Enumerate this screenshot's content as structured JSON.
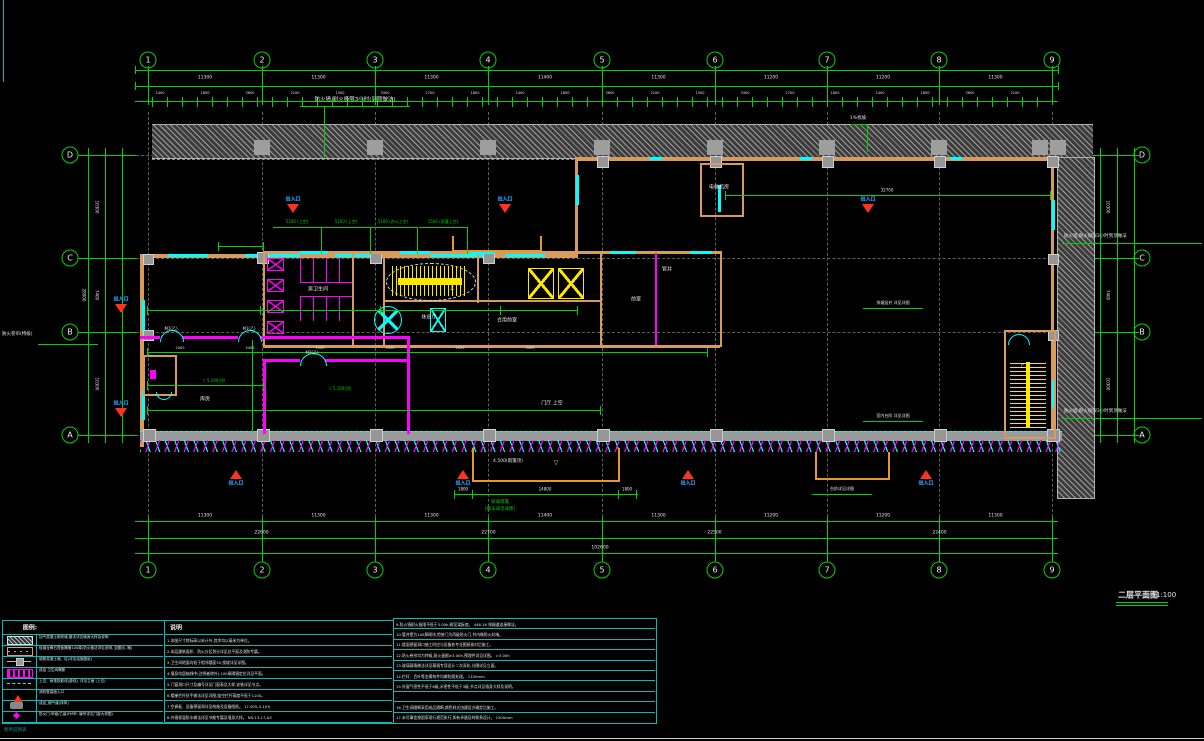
{
  "title": {
    "text": "二层平面图",
    "scale": "1:100"
  },
  "grid": {
    "cols": [
      "1",
      "2",
      "3",
      "4",
      "5",
      "6",
      "7",
      "8",
      "9"
    ],
    "rows": [
      "D",
      "C",
      "B",
      "A"
    ]
  },
  "dims": {
    "top_bays": [
      "11300",
      "11300",
      "11300",
      "11400",
      "11300",
      "11200",
      "11200",
      "11300"
    ],
    "top_fine": [
      "2400",
      "1800",
      "3600",
      "2100",
      "1500",
      "3300",
      "2700",
      "1800"
    ],
    "bottom_bays": [
      "11300",
      "11300",
      "11300",
      "11400",
      "11300",
      "11200",
      "11200",
      "11300"
    ],
    "bottom_spans": [
      "22600",
      "22700",
      "22500",
      "22400"
    ],
    "bottom_overall": "102600",
    "left": [
      "10300",
      "7400",
      "10300"
    ],
    "left_overall": "28000",
    "right": [
      "10300",
      "7400",
      "10300"
    ],
    "canopy": [
      "1800",
      "14800",
      "1800"
    ],
    "upper_span": "32700",
    "inner": [
      "2000",
      "5400",
      "1500",
      "3300",
      "2000",
      "5400"
    ]
  },
  "annotations": {
    "firewall_top": "防火墙,耐火极限3小时(到顶做法)",
    "firewall_right_upper": "防火墙,耐火极限3小时到顶做法",
    "firewall_right_lower": "防火墙,耐火极限3小时到顶做法",
    "slope": "1%找坡",
    "shutter": "防火卷帘(特级)",
    "upper_labels": [
      "5100 (上空)",
      "5100 (上空)",
      "5100 (办公上空)",
      "1500 (雨篷上空)"
    ],
    "canopy_level": "4.500(雨篷顶)",
    "canopy_note_1": "玻璃雨篷",
    "canopy_note_2": "(做法详见详图)",
    "leaders": [
      {
        "text": "排烟竖井 详见详图",
        "x": 893,
        "y": 303
      },
      {
        "text": "室内台阶 详见详图",
        "x": 893,
        "y": 416
      },
      {
        "text": "台阶详见详图",
        "x": 842,
        "y": 489
      }
    ],
    "levels": [
      {
        "text": "5.100(顶)",
        "x": 214,
        "y": 381
      },
      {
        "text": "5.100(顶)",
        "x": 340,
        "y": 389
      }
    ],
    "doors": [
      {
        "text": "M1(乙)",
        "x": 171,
        "y": 329
      },
      {
        "text": "M1(乙)",
        "x": 249,
        "y": 329
      },
      {
        "text": "M2(乙)",
        "x": 312,
        "y": 353
      }
    ],
    "stair_up": "上"
  },
  "markers": {
    "label": "出入口",
    "points": [
      {
        "x": 293,
        "y": 199,
        "dir": "down"
      },
      {
        "x": 505,
        "y": 199,
        "dir": "down"
      },
      {
        "x": 868,
        "y": 199,
        "dir": "down"
      },
      {
        "x": 121,
        "y": 299,
        "dir": "down"
      },
      {
        "x": 121,
        "y": 403,
        "dir": "down"
      },
      {
        "x": 236,
        "y": 471,
        "dir": "up"
      },
      {
        "x": 463,
        "y": 471,
        "dir": "up"
      },
      {
        "x": 688,
        "y": 471,
        "dir": "up"
      },
      {
        "x": 926,
        "y": 471,
        "dir": "up"
      }
    ]
  },
  "rooms": [
    {
      "label": "男卫生间",
      "x": 318,
      "y": 289
    },
    {
      "label": "休息厅",
      "x": 429,
      "y": 317
    },
    {
      "label": "合用前室",
      "x": 507,
      "y": 320
    },
    {
      "label": "前室",
      "x": 636,
      "y": 299
    },
    {
      "label": "管井",
      "x": 667,
      "y": 269
    },
    {
      "label": "库房",
      "x": 205,
      "y": 399
    },
    {
      "label": "门厅 上空",
      "x": 552,
      "y": 403
    },
    {
      "label": "电梯机房",
      "x": 719,
      "y": 187
    }
  ],
  "legend": {
    "title": "图例:",
    "rows": [
      {
        "symbol": "hatch-gray",
        "desc": "加气混凝土砌块墙,做法详见墙身大样及说明"
      },
      {
        "symbol": "wall-tan",
        "desc": "轻钢龙骨石膏板隔墙100厚(防火做法详见说明, 如图示, 略)"
      },
      {
        "symbol": "rc-wall",
        "desc": "钢筋混凝土墙、柱(详见结施图纸)"
      },
      {
        "symbol": "hatch-magenta",
        "desc": "成品 卫生间隔断"
      },
      {
        "symbol": "dash-cyan",
        "desc": "上空、雨篷投影线(虚线), 详见立面  (上空)"
      },
      {
        "symbol": "tri-red",
        "desc": "消防登高面入口"
      },
      {
        "symbol": "vent-gray",
        "desc": "成品_烟气道(排风)"
      },
      {
        "symbol": "diamond-magenta",
        "desc": "防火门:甲级/乙级(FM甲- 编号详见门窗大样图)"
      }
    ]
  },
  "notes": {
    "title": "说明",
    "col1": [
      "1.本图尺寸除标高以米计外,其余均以毫米为单位。",
      "2.本层建筑面积、防火分区划分详见总平面及消防专篇。",
      "3.卫生间地面均低于相邻楼面30,找坡详见详图。",
      "4.墙身均居轴线中(注明者除外),100厚隔墙定位详见平面。",
      "5.门窗洞口尺寸及编号详见门窗表及大样,安装详见节点。",
      "6.楼梯栏杆扶手做法详见详图,临空栏杆高度不低于1100。",
      "7.空调板、设备预留洞详见结施及设备图纸。  17.005-3.1(H)",
      "8.外墙保温防水做法详见节能专篇及墙身大样。  NS:13-17-A3"
    ],
    "col2": [
      "9.防火墙耐火极限不低于3.00h,砌至梁板底。  446.16 排烟道连接做法。",
      "10.管井壁为100厚砌块,检修门为丙级防火门,井内做防火封堵。",
      "11.楼面预留洞口施工时应与设备各专业图纸核对后施工。",
      "12.防火卷帘均为特级,耐火极限≥3.00h,预埋件详见详图。  >3.00h",
      "13.玻璃幕墙做法详见幕墙专项设计二次深化,分隔详见立面。",
      "14.栏杆、百叶等金属构件均做防腐处理。  1100mm",
      "15.外窗气密性不低于6级,水密性不低于3级,节点详见墙身大样及说明。",
      "-",
      "16.卫生间隔断采用成品隔断,颜色样式由建设方确定后施工。",
      "17.未尽事宜按国家现行规范执行,如有矛盾及时联系设计。  1500mm"
    ]
  },
  "footer": "图例说明表"
}
